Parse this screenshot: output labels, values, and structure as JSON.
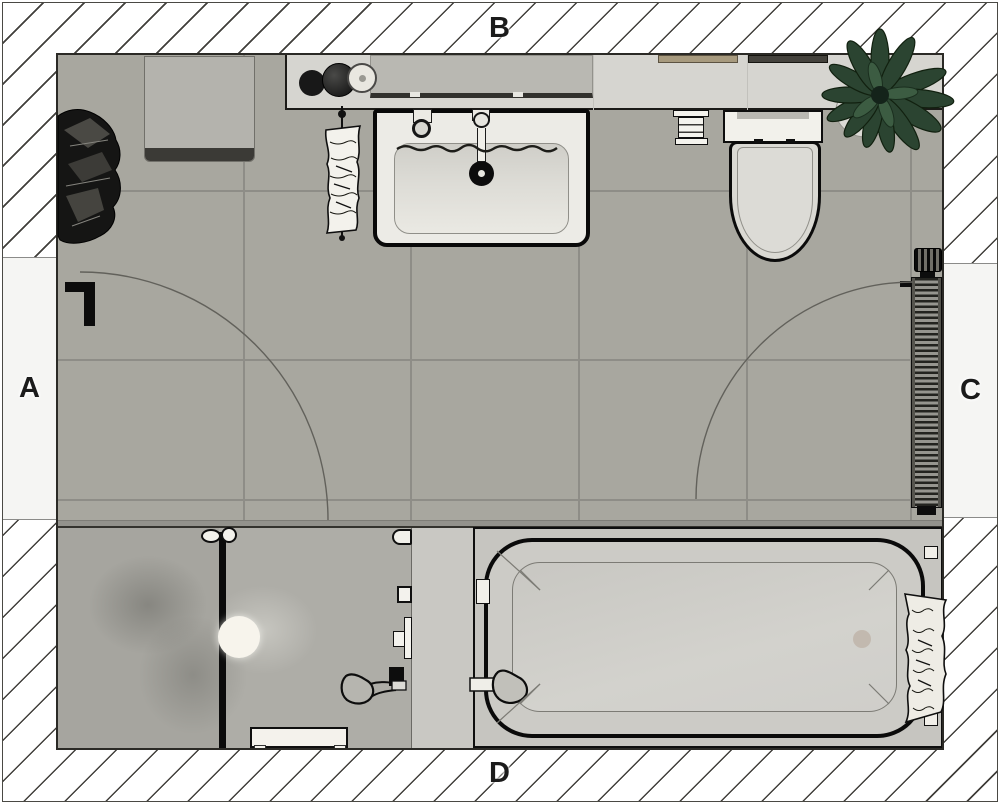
{
  "wall_labels": {
    "left": "A",
    "top": "B",
    "right": "C",
    "bottom": "D"
  },
  "palette": {
    "floor": "#a8a79f",
    "grout": "#8e8d87",
    "wall_hatch_line": "#413f3b",
    "counter": "#d6d5d0",
    "mirror_cabinet": "#b9b8b2",
    "storage_cabinet": "#b4b3ad",
    "fixture_white": "#f2f1eb",
    "tub_fill": "#cccbc6",
    "shower_floor": "#aeada7",
    "plant_green": "#2b4431",
    "outline_black": "#0d0d0d"
  },
  "fixtures": [
    "storage-cabinet",
    "bathrobe",
    "vanity-counter",
    "mirror-cabinet",
    "soap-dispensers",
    "washbasin",
    "faucet",
    "hand-towel",
    "toilet-paper-holder",
    "toilet",
    "plant",
    "radiator",
    "door-left",
    "door-right",
    "shower-enclosure",
    "shower-head",
    "hand-shower",
    "shower-bench",
    "bathtub",
    "bath-hand-shower",
    "bath-towel"
  ]
}
